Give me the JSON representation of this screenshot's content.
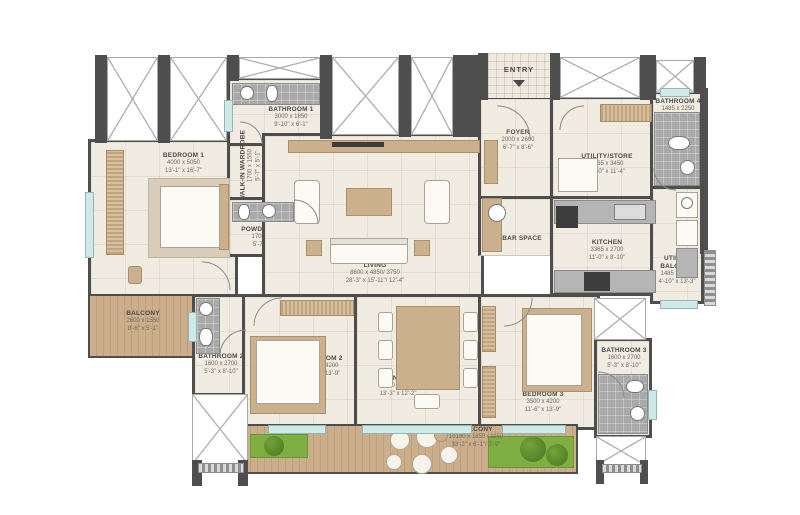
{
  "title": "3-bedroom apartment floor plan",
  "entry": {
    "label": "ENTRY"
  },
  "rooms": {
    "bedroom1": {
      "name": "BEDROOM 1",
      "mm": "4000 x 5050",
      "ft": "13'-1\" x 16'-7\""
    },
    "bathroom1": {
      "name": "BATHROOM 1",
      "mm": "3000 x 1850",
      "ft": "9'-10\" x 6'-1\""
    },
    "wiw": {
      "name": "WALK-IN WARDROBE",
      "mm": "1700 x 1550",
      "ft": "5'-7\" x 5'-1\""
    },
    "powder": {
      "name": "POWDER ROOM",
      "mm": "1700 x 1600",
      "ft": "5'-7\" x 5'-3\""
    },
    "living": {
      "name": "LIVING",
      "mm": "8600 x 4850/ 3750",
      "ft": "28'-3\" x 15'-11\"/ 12'-4\""
    },
    "foyer": {
      "name": "FOYER",
      "mm": "2000 x 2600",
      "ft": "6'-7\" x 8'-6\""
    },
    "utilitystore": {
      "name": "UTILITY/STORE",
      "mm": "3365 x 3450",
      "ft": "11'-0\" x 11'-4\""
    },
    "bathroom4": {
      "name": "BATHROOM 4",
      "mm": "1485 x 2250",
      "ft": "4'-10\" x 7'-5\""
    },
    "barspace": {
      "name": "BAR SPACE"
    },
    "kitchen": {
      "name": "KITCHEN",
      "mm": "3365 x 2700",
      "ft": "11'-0\" x 8'-10\""
    },
    "utilitybalcony": {
      "name": "UTILITY BALCONY",
      "mm": "1485 x 4050",
      "ft": "4'-10\" x 13'-3\""
    },
    "balconyleft": {
      "name": "BALCONY",
      "mm": "2600 x 1550",
      "ft": "8'-6\" x 5'-1\""
    },
    "bathroom2": {
      "name": "BATHROOM 2",
      "mm": "1600 x 2700",
      "ft": "5'-3\" x 8'-10\""
    },
    "bedroom2": {
      "name": "BEDROOM 2",
      "mm": "3500 x 4200",
      "ft": "11'-6\" x 13'-9\""
    },
    "dining": {
      "name": "DINING",
      "mm": "4050 x 3700",
      "ft": "13'-3\" x 12'-2\""
    },
    "bedroom3": {
      "name": "BEDROOM 3",
      "mm": "3500 x 4200",
      "ft": "11'-6\" x 13'-9\""
    },
    "bathroom3": {
      "name": "BATHROOM 3",
      "mm": "1600 x 2700",
      "ft": "5'-3\" x 8'-10\""
    },
    "balconybottom": {
      "name": "BALCONY",
      "mm": "10100 x 1850 / 1150",
      "ft": "33'-2\" x 6'-1\"/ 3'-9\""
    }
  },
  "colors": {
    "wall": "#4e4e4e",
    "floor": "#f1ece2",
    "wood": "#cbb08e",
    "deck": "#c9ad8c",
    "grass": "#7fae43",
    "tile": "#a9a9a9",
    "glass": "#cfe9e9"
  }
}
